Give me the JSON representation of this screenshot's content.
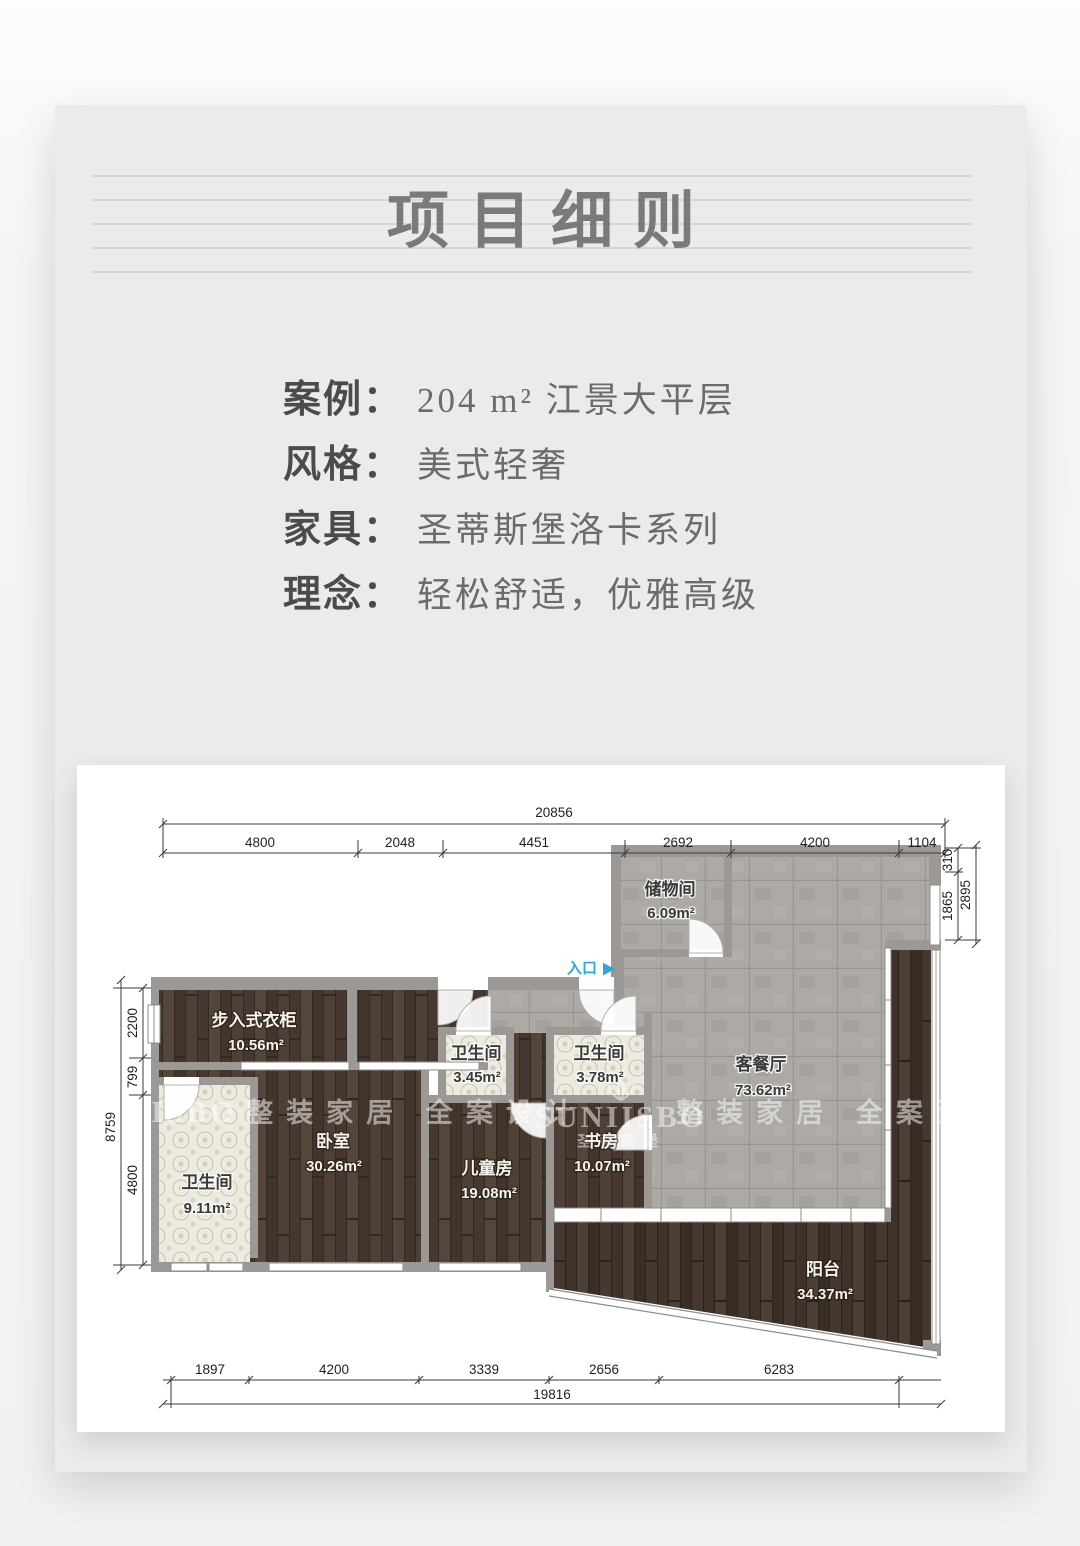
{
  "palette": {
    "page_background": "#f4f4f2",
    "card_background": "#ebebea",
    "title_color": "#7a7a7a",
    "wall_color": "#9b9896",
    "wood_floor": "#4b3d33",
    "tile_floor": "#a9a6a2",
    "bath_tile": "#edebe0",
    "entrance_accent": "#2ea7d8"
  },
  "header": {
    "title": "项目细则"
  },
  "info": {
    "rows": [
      {
        "label": "案例：",
        "value": "204 m² 江景大平层"
      },
      {
        "label": "风格：",
        "value": "美式轻奢"
      },
      {
        "label": "家具：",
        "value": "圣蒂斯堡洛卡系列"
      },
      {
        "label": "理念：",
        "value": "轻松舒适，优雅高级"
      }
    ]
  },
  "floorplan": {
    "entrance_label": "入口",
    "entrance_arrow": "▶",
    "rooms": {
      "storage": {
        "name": "储物间",
        "area": "6.09m²"
      },
      "living": {
        "name": "客餐厅",
        "area": "73.62m²"
      },
      "closet": {
        "name": "步入式衣柜",
        "area": "10.56m²"
      },
      "bath_a": {
        "name": "卫生间",
        "area": "3.45m²"
      },
      "bath_b": {
        "name": "卫生间",
        "area": "3.78m²"
      },
      "bedroom": {
        "name": "卧室",
        "area": "30.26m²"
      },
      "kids": {
        "name": "儿童房",
        "area": "19.08m²"
      },
      "study": {
        "name": "书房",
        "area": "10.07m²"
      },
      "bath_master": {
        "name": "卫生间",
        "area": "9.11m²"
      },
      "balcony": {
        "name": "阳台",
        "area": "34.37m²"
      }
    },
    "dims": {
      "top_total": "20856",
      "top_segments": [
        "4800",
        "2048",
        "4451",
        "2692",
        "4200",
        "1104"
      ],
      "right_segments": [
        "310",
        "1865"
      ],
      "right_total": "2895",
      "left_total": "8759",
      "left_segments": [
        "2200",
        "799",
        "4800"
      ],
      "bottom_segments": [
        "1897",
        "4200",
        "3339",
        "2656",
        "6283"
      ],
      "bottom_total": "19816"
    },
    "watermarks": {
      "brand": "SUNIISBO",
      "brand_cn": "圣蒂斯堡",
      "slogan": "整装家居 全案设计"
    }
  }
}
